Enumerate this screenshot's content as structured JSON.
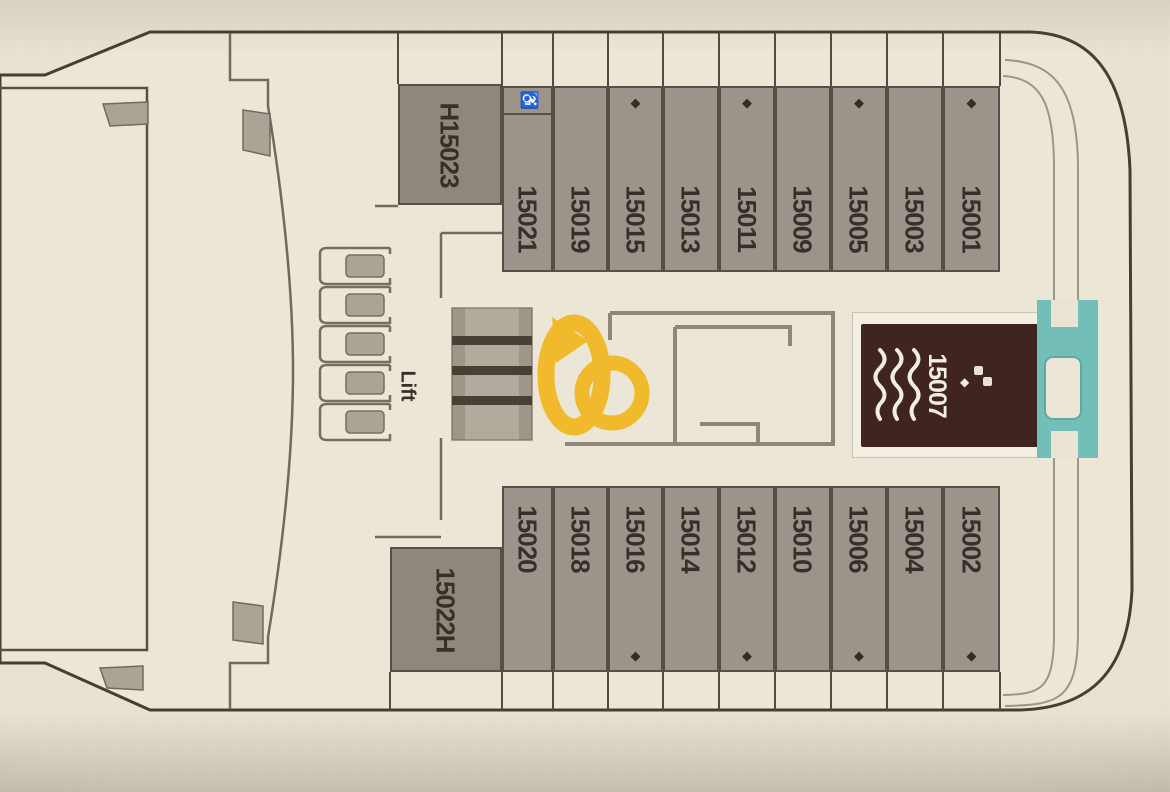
{
  "plan": {
    "lift_label": "Lift",
    "icons": {
      "diamond": "◆",
      "wheelchair": "♿"
    },
    "top_row": [
      {
        "number": "H15023",
        "accessible": true,
        "diamond": false
      },
      {
        "number": "15021",
        "wheelchair_icon": true,
        "diamond": false
      },
      {
        "number": "15019",
        "diamond": false
      },
      {
        "number": "15015",
        "diamond": true
      },
      {
        "number": "15013",
        "diamond": false
      },
      {
        "number": "15011",
        "diamond": true
      },
      {
        "number": "15009",
        "diamond": false
      },
      {
        "number": "15005",
        "diamond": true
      },
      {
        "number": "15003",
        "diamond": false
      },
      {
        "number": "15001",
        "diamond": true
      }
    ],
    "bottom_row": [
      {
        "number": "15022H",
        "accessible": true,
        "diamond": false
      },
      {
        "number": "15020",
        "diamond": false
      },
      {
        "number": "15018",
        "diamond": false
      },
      {
        "number": "15016",
        "diamond": true
      },
      {
        "number": "15014",
        "diamond": false
      },
      {
        "number": "15012",
        "diamond": true
      },
      {
        "number": "15010",
        "diamond": false
      },
      {
        "number": "15006",
        "diamond": true
      },
      {
        "number": "15004",
        "diamond": false
      },
      {
        "number": "15002",
        "diamond": true
      }
    ],
    "aft_suite": {
      "number": "15007",
      "diamond": true,
      "features": [
        "whirlpool"
      ]
    },
    "colors": {
      "deck_fill": "#ece6d7",
      "hull_outline": "#463e33",
      "cabin_fill": "#9c948a",
      "accessible_cabin_fill": "#8f877c",
      "cabin_border": "#554f47",
      "number_text": "#36302a",
      "suite_fill": "#40241f",
      "suite_text": "#f2eee2",
      "aft_platform_teal": "#74beba",
      "watermark_yellow": "#f1b71e"
    }
  }
}
